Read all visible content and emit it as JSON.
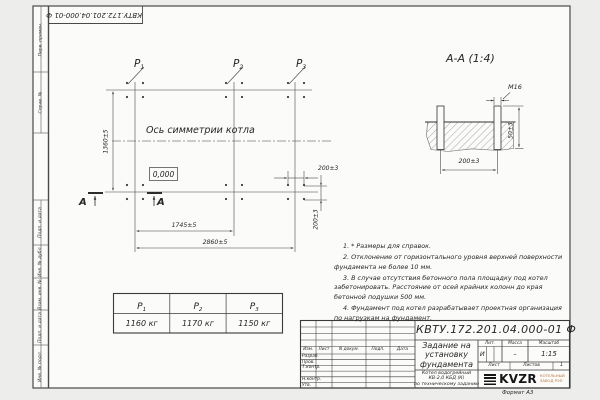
{
  "sheet": {
    "doc_number": "КВТУ.172.201.04.000-01 Ф",
    "format_label": "Формат А3"
  },
  "frame_strip": {
    "top": [
      "Перв. примен.",
      "Справ. №"
    ],
    "bottom": [
      "Подп. и дата",
      "Инв. № дубл.",
      "Взам. инв. №",
      "Подп. и дата",
      "Инв. № подл."
    ]
  },
  "plan": {
    "points": [
      {
        "name": "Р",
        "sub": "1"
      },
      {
        "name": "Р",
        "sub": "2"
      },
      {
        "name": "Р",
        "sub": "3"
      }
    ],
    "symmetry_label": "Ось симметрии котла",
    "elevation": "0,000",
    "section_letter": "А",
    "dim_height": "1360±5",
    "dim_col_span": "1745±5",
    "dim_total_span": "2860±5",
    "dim_bolt_h": "200±3",
    "dim_bolt_v": "200±3"
  },
  "section": {
    "title": "А-А (1:4)",
    "bolt_thread": "М16",
    "dim_protrusion": "50±3",
    "dim_spacing": "200±3"
  },
  "load_table": {
    "headers": [
      {
        "name": "Р",
        "sub": "1"
      },
      {
        "name": "Р",
        "sub": "2"
      },
      {
        "name": "Р",
        "sub": "3"
      }
    ],
    "values": [
      "1160 кг",
      "1170 кг",
      "1150 кг"
    ]
  },
  "notes": [
    "1. * Размеры для справок.",
    "2. Отклонение от горизонтального уровня верхней поверхности фундамента не более 10 мм.",
    "3. В случае отсутствия бетонного пола площадку под котел забетонировать. Расстояние от осей крайних колонн до края бетонной подушки 500 мм.",
    "4. Фундамент под котел разрабатывает проектная организация по нагрузкам на фундамент."
  ],
  "title_block": {
    "doc_number": "КВТУ.172.201.04.000-01 Ф",
    "title_lines": [
      "Задание на",
      "установку",
      "фундамента"
    ],
    "column_headers": [
      "Изм.",
      "Лист",
      "N докум.",
      "Подп.",
      "Дата"
    ],
    "row_labels": [
      "Разраб.",
      "Пров.",
      "Т.контр.",
      "Н.контр.",
      "Утв."
    ],
    "lit_header": "Лит.",
    "lit_value": "И",
    "mass_header": "Масса",
    "mass_value": "–",
    "scale_header": "Масштаб",
    "scale_value": "1:15",
    "sheet_label": "Лист",
    "sheets_label": "Листов",
    "sheets_value": "1",
    "product_lines": [
      "Котел водогрейный",
      "КВ-2,0 КБД (К)",
      "по техническому заданию"
    ],
    "logo_text": "KVZR",
    "logo_caption": [
      "КОТЕЛЬНЫЙ",
      "ЗАВОД РЭП"
    ]
  }
}
